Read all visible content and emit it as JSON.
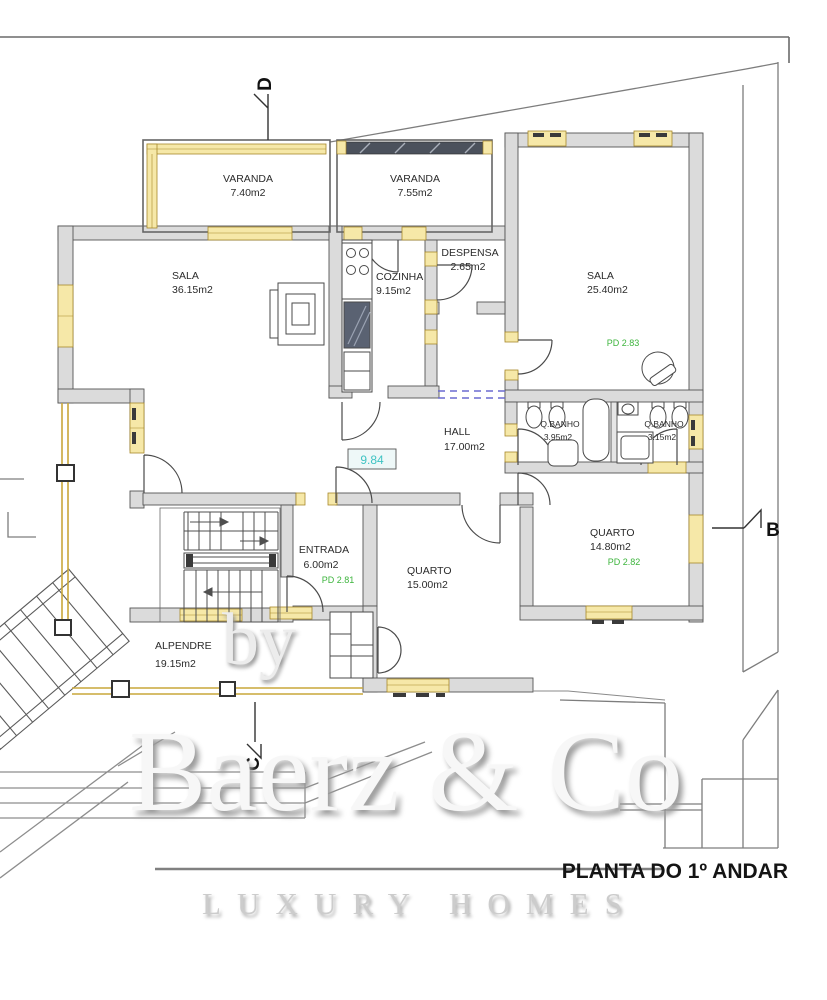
{
  "title": "PLANTA DO 1º ANDAR",
  "section_markers": {
    "d": "D",
    "b": "B",
    "c": "C"
  },
  "rooms": {
    "varanda1": {
      "name": "VARANDA",
      "area": "7.40m2"
    },
    "varanda2": {
      "name": "VARANDA",
      "area": "7.55m2"
    },
    "sala_grande": {
      "name": "SALA",
      "area": "36.15m2"
    },
    "cozinha": {
      "name": "COZINHA",
      "area": "9.15m2"
    },
    "despensa": {
      "name": "DESPENSA",
      "area": "2.65m2"
    },
    "sala": {
      "name": "SALA",
      "area": "25.40m2",
      "pd": "PD 2.83"
    },
    "qbanho1": {
      "name": "Q.BANHO",
      "area": "3.95m2"
    },
    "qbanho2": {
      "name": "Q.BANHO",
      "area": "3.15m2"
    },
    "hall": {
      "name": "HALL",
      "area": "17.00m2",
      "level": "9.84"
    },
    "entrada": {
      "name": "ENTRADA",
      "area": "6.00m2",
      "pd": "PD 2.81"
    },
    "quarto1": {
      "name": "QUARTO",
      "area": "15.00m2"
    },
    "quarto2": {
      "name": "QUARTO",
      "area": "14.80m2",
      "pd": "PD 2.82"
    },
    "alpendre": {
      "name": "ALPENDRE",
      "area": "19.15m2"
    }
  },
  "watermark": {
    "by": "by",
    "brand": "Baerz & Co",
    "tagline": "LUXURY HOMES"
  },
  "colors": {
    "wall_fill": "#dbdbdb",
    "wall_stroke": "#555555",
    "window_fill": "#f6e8a8",
    "window_stroke": "#a8882a",
    "pd_green": "#3cb43c",
    "level_cyan": "#3fc3c3",
    "site_line": "#7d7d7d",
    "glazing_dark": "#4b515c"
  }
}
